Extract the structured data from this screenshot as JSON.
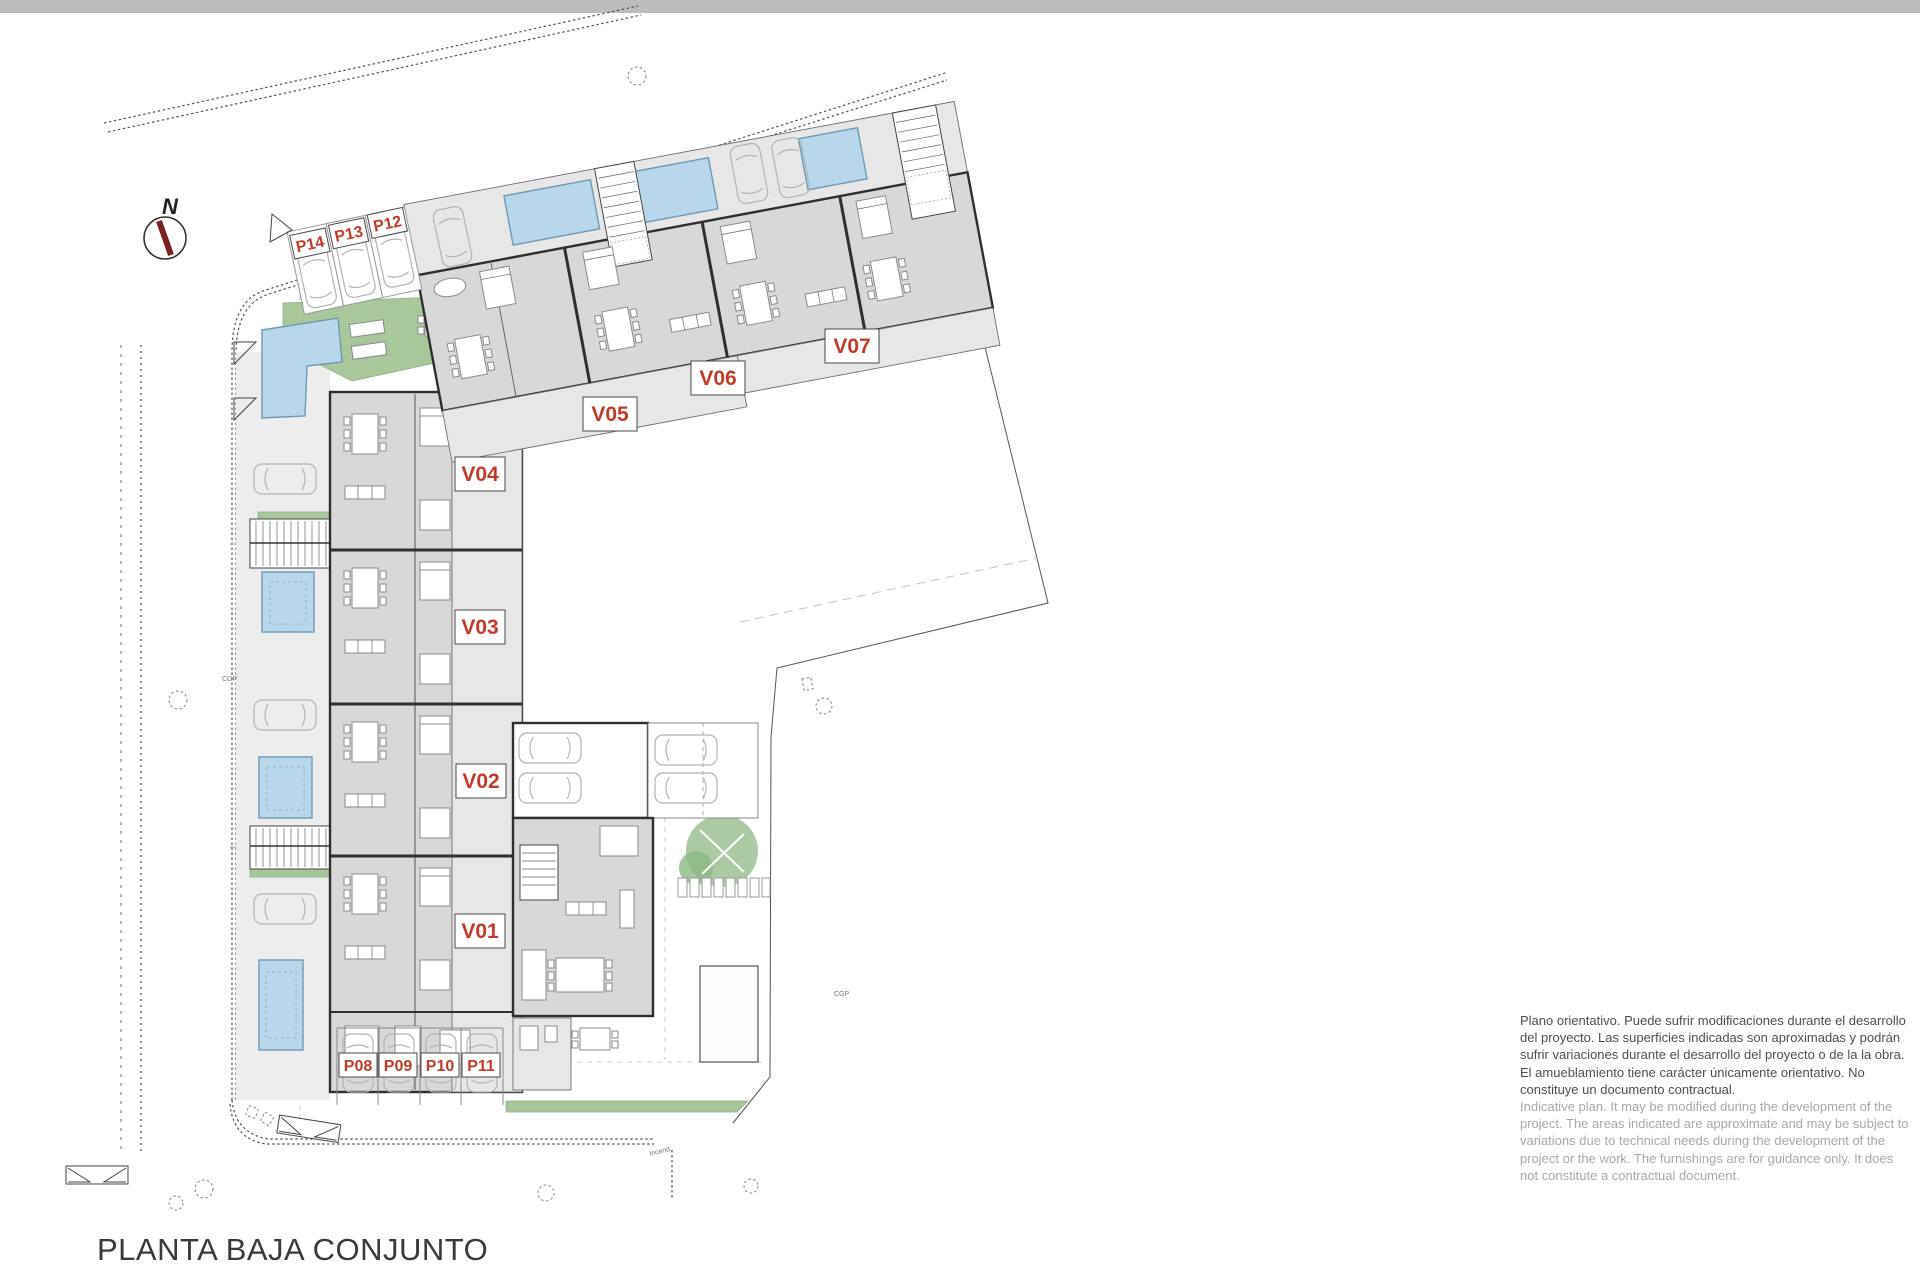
{
  "title": "PLANTA BAJA CONJUNTO",
  "north": "N",
  "disclaimer": {
    "es_lines": [
      "Plano orientativo. Puede sufrir modificaciones durante el desarrollo",
      "del proyecto. Las superficies indicadas son aproximadas y podrán",
      "sufrir variaciones durante el desarrollo del proyecto o de la la obra.",
      "El amueblamiento tiene carácter únicamente orientativo. No",
      "constituye un documento contractual."
    ],
    "en_lines": [
      "Indicative plan. It may be modified during the development of the",
      "project. The areas indicated are approximate and may be subject to",
      "variations due to technical needs during the development of the",
      "project or the work. The furnishings are for guidance only. It does",
      "not constitute a contractual document."
    ]
  },
  "units": [
    {
      "id": "V01"
    },
    {
      "id": "V02"
    },
    {
      "id": "V03"
    },
    {
      "id": "V04"
    },
    {
      "id": "V05"
    },
    {
      "id": "V06"
    },
    {
      "id": "V07"
    }
  ],
  "parking": [
    {
      "id": "P08"
    },
    {
      "id": "P09"
    },
    {
      "id": "P10"
    },
    {
      "id": "P11"
    },
    {
      "id": "P12"
    },
    {
      "id": "P13"
    },
    {
      "id": "P14"
    }
  ],
  "annotations": {
    "cgp": "CGP",
    "incend": "Incend."
  },
  "colors": {
    "accent_red": "#c43b2b",
    "pool_blue": "#b8d7eb",
    "green": "#a8c79a",
    "bar_gray": "#bcbcbc",
    "building_gray": "#d8d8d8"
  }
}
